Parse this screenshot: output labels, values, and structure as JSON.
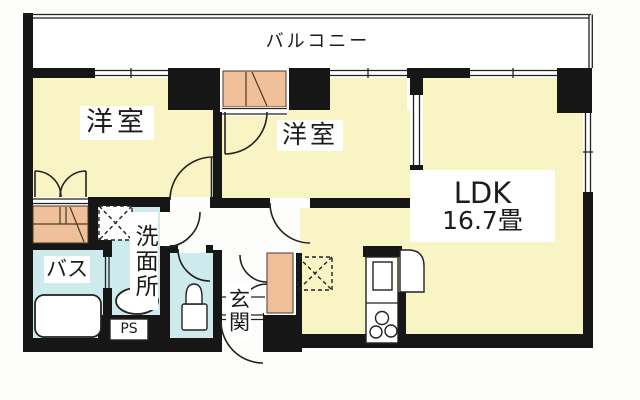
{
  "plan": {
    "balcony_label": "バルコニー",
    "room1_label": "洋室",
    "room2_label": "洋室",
    "ldk_label": "LDK",
    "ldk_area": "16.7畳",
    "washroom_label": "洗面所",
    "bath_label": "バス",
    "entrance_label": "玄関",
    "pipe_space_label": "PS"
  },
  "colors": {
    "wall": "#161616",
    "room_yellow": "#f8f4c3",
    "wet_blue": "#cdebec",
    "closet_orange": "#f0c09a",
    "line": "#222222",
    "text_color": "#1c1c1c"
  }
}
